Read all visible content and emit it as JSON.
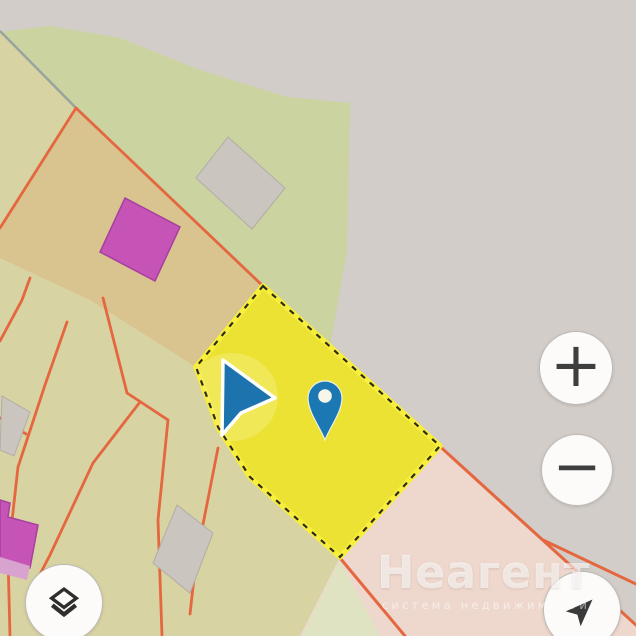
{
  "watermark": {
    "title": "Неагент",
    "subtitle": "система недвижимости"
  },
  "controls": {
    "zoom_in": {
      "label": "+"
    },
    "zoom_out": {
      "label": "−"
    },
    "layers": {
      "icon": "layers-icon"
    },
    "locate": {
      "icon": "navigation-arrow-icon"
    }
  },
  "map": {
    "selected_parcel": {
      "highlighted": true,
      "border_style": "dashed"
    },
    "markers": {
      "pin": "location-pin",
      "cursor": "navigation-cursor"
    },
    "colors": {
      "background_grey": "#d3cdc9",
      "land_olive": "#d8d3a3",
      "land_green": "#cbd3a0",
      "land_tan": "#d9c38f",
      "land_pink": "#eed7cd",
      "land_pale_green": "#dfe3c1",
      "parcel_boundary": "#e4673f",
      "road_grey": "#99a49f",
      "selected_parcel_fill": "#ebe233",
      "selected_parcel_glow": "#f8ef3a",
      "selected_parcel_dash": "#2f2c1c",
      "pin_blue": "#1b78b3",
      "cursor_blue": "#1c73ae",
      "building_magenta": "#c554b6",
      "building_grey": "#cbc5bf"
    }
  }
}
